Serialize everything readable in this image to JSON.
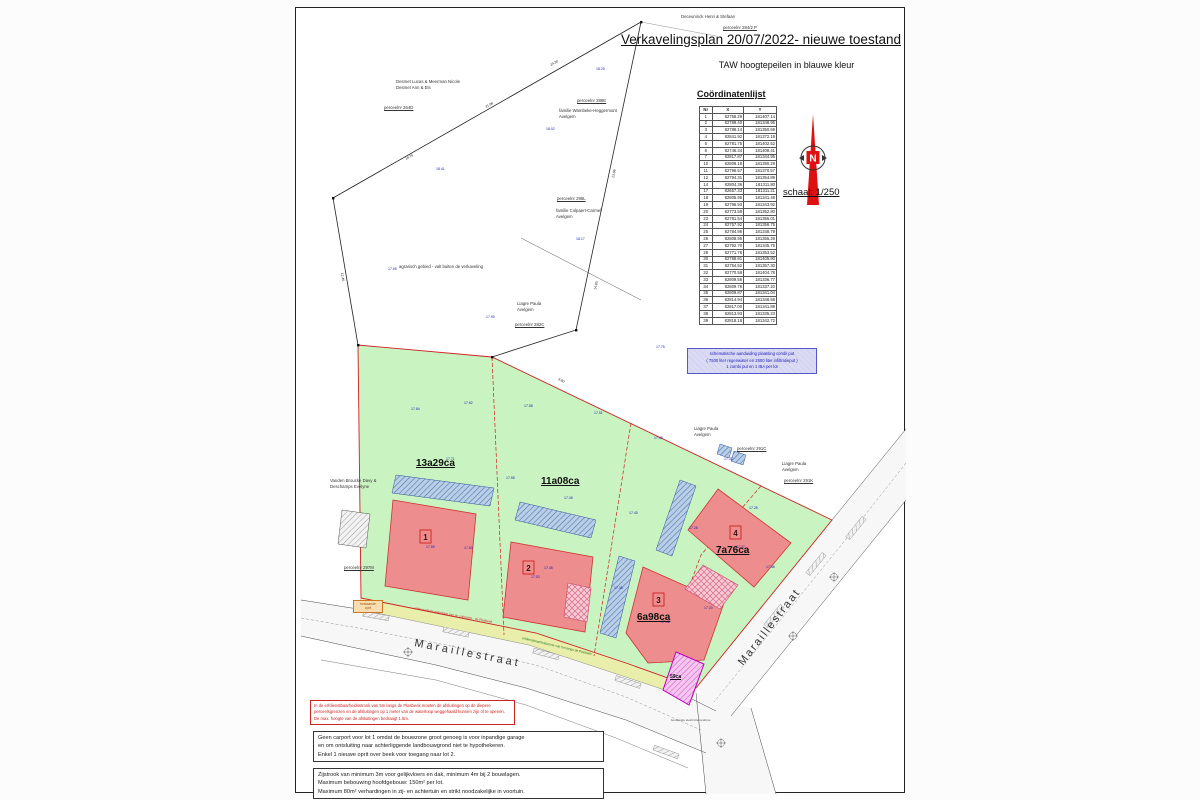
{
  "header": {
    "title": "Verkavelingsplan 20/07/2022- nieuwe toestand",
    "subtitle": "TAW hoogtepeilen in blauwe kleur"
  },
  "north": {
    "n": "N",
    "scale": "schaal: 1/250"
  },
  "coordinates": {
    "heading": "Coördinatenlijst",
    "columns": [
      "Nr",
      "X",
      "Y"
    ],
    "rows": [
      [
        "1",
        "82758.29",
        "181407.14"
      ],
      [
        "2",
        "82789.40",
        "181348.95"
      ],
      [
        "3",
        "82788.14",
        "181350.59"
      ],
      [
        "4",
        "82841.92",
        "181372.19"
      ],
      [
        "5",
        "82781.75",
        "181402.52"
      ],
      [
        "6",
        "82746.34",
        "181408.41"
      ],
      [
        "7",
        "82817.87",
        "181344.95"
      ],
      [
        "10",
        "82808.18",
        "181390.29"
      ],
      [
        "11",
        "82796.57",
        "181370.57"
      ],
      [
        "12",
        "82794.31",
        "181354.89"
      ],
      [
        "14",
        "82804.36",
        "181311.80"
      ],
      [
        "17",
        "82657.33",
        "181311.21"
      ],
      [
        "18",
        "82805.95",
        "181341.48"
      ],
      [
        "19",
        "82796.93",
        "181343.92"
      ],
      [
        "20",
        "82773.58",
        "181352.80"
      ],
      [
        "23",
        "82781.54",
        "181355.01"
      ],
      [
        "24",
        "82757.92",
        "181356.75"
      ],
      [
        "25",
        "82784.96",
        "181348.79"
      ],
      [
        "26",
        "82808.95",
        "181355.26"
      ],
      [
        "27",
        "82792.70",
        "181345.75"
      ],
      [
        "28",
        "82771.76",
        "181353.52"
      ],
      [
        "30",
        "82788.91",
        "181405.90"
      ],
      [
        "31",
        "82754.52",
        "181357.30"
      ],
      [
        "32",
        "82770.58",
        "181404.78"
      ],
      [
        "33",
        "82809.56",
        "181336.77"
      ],
      [
        "34",
        "82809.76",
        "181337.20"
      ],
      [
        "35",
        "82809.87",
        "181341.04"
      ],
      [
        "36",
        "82814.94",
        "181346.58"
      ],
      [
        "37",
        "82817.00",
        "181341.88"
      ],
      [
        "38",
        "82813.93",
        "181335.23"
      ],
      [
        "39",
        "82818.18",
        "181342.72"
      ]
    ]
  },
  "lots": [
    {
      "nr": "1",
      "area": "13a29ca"
    },
    {
      "nr": "2",
      "area": "11a08ca"
    },
    {
      "nr": "3",
      "area": "6a98ca"
    },
    {
      "nr": "4",
      "area": "7a76ca"
    }
  ],
  "extra_parcel": "59ca",
  "streets": {
    "bottom": "Maraillestraat",
    "right": "Maraillestraat"
  },
  "owners": {
    "deceuninck": {
      "name": "Deceuninck Henri & Stefaan",
      "parcel": "perceelnr 284/2 P"
    },
    "desmet": {
      "line1": "Desmet Lucas & Meerman Nicole",
      "line2": "Desmet Ann & Els",
      "parcel": "perceelnr 264D"
    },
    "wambeke": {
      "line1": "familie Wambeke-Heggermont",
      "line2": "Avelgem",
      "parcel": "perceelnr 288E"
    },
    "colpaert": {
      "line1": "familie Colpaert-Carmel",
      "line2": "Avelgem",
      "parcel": "perceelnr 295L"
    },
    "liagre282": {
      "line1": "Liagre Paula",
      "line2": "Avelgem",
      "parcel": "perceelnr 282C"
    },
    "vandenbroucke": {
      "line1": "Vanden Broucke Davy &",
      "line2": "Deschamps Evelyne",
      "parcel": "perceelnr 297M"
    },
    "liagre291c": {
      "line1": "Liagre Paula",
      "line2": "Avelgem",
      "parcel": "perceelnr 291C"
    },
    "liagre291k": {
      "line1": "Liagre Paula",
      "line2": "Avelgem",
      "parcel": "perceelnr 291K"
    }
  },
  "notes": {
    "agrarisch": "agrarisch gebied - valt buiten de verkaveling",
    "bestaande_oprit_1": "bestaande",
    "bestaande_oprit_2": "oprit",
    "cabine": "bestaande elektriciteitscabine"
  },
  "road_labels": {
    "waterloop": "onbevaarbare waterloop van 2e categorie - de Plasbeek",
    "erfdienst": "erfdienstbaarheidszone van 5m langs de Plasbeek"
  },
  "combi_box": {
    "line1": "schematische aanduiding plaatsing combi put",
    "line2": "( 7500 liter regenwater en 2500 liter infiltratieput )",
    "line3": "1 combi put en 1 IBA per lot"
  },
  "plasbeek_box": {
    "line1": "In de erfdienstbaarheidsstrook van 5m langs de Plasbeek moeten de afsluitingen op de diepere",
    "line2": "perceelsgrenzen en de afsluitingen op 1 meter van de waterloop weggehaald kunnen zijn of te openen.",
    "line3": "De max. hoogte van de afsluitingen bedraagt 1.5m."
  },
  "carport_box": {
    "line1": "Geen carport voor lot 1 omdat de bouwzone groot genoeg is voor inpandige garage",
    "line2": "en om ontsluiting naar achterliggende landbouwgrond niet te hypothekeren.",
    "line3": "Enkel 1 nieuwe oprit over beek voor toegang naar lot 2."
  },
  "zijstrook_box": {
    "line1": "Zijstrook van minimum 3m voor gelijkvloers en dak, minimum 4m bij 2 bouwlagen.",
    "line2": "Maximum bebouwing hoofdgebouw: 150m² per lot.",
    "line3": "Maximum 80m² verhardingen in zij- en achtertuin en strikt noodzakelijke in voortuin."
  },
  "plan": {
    "heights": [
      "17.84",
      "17.62",
      "17.58",
      "17.51",
      "17.48",
      "17.32",
      "17.71",
      "17.55",
      "17.49",
      "17.40",
      "17.28",
      "17.25",
      "17.45",
      "17.38",
      "17.60",
      "17.20",
      "18.41",
      "18.02",
      "17.95",
      "18.17",
      "18.29",
      "17.90",
      "17.75",
      "17.36",
      "17.59",
      "17.53",
      "17.42",
      "17.37"
    ],
    "dims": [
      "31.98",
      "24.30",
      "18.75",
      "23.06",
      "14.83",
      "12.45",
      "9.80"
    ]
  },
  "colors": {
    "verkaveling_green": "#c9f3c0",
    "bouwzone_red": "#ee8d8d",
    "boundary_red": "#cc2222",
    "hatch_blue": "#b9cfe6",
    "strip_yellow": "#e9eeab",
    "north_red": "#dd1111",
    "taw_blue": "#2222bb",
    "parcel_magenta": "#bb00bb"
  }
}
